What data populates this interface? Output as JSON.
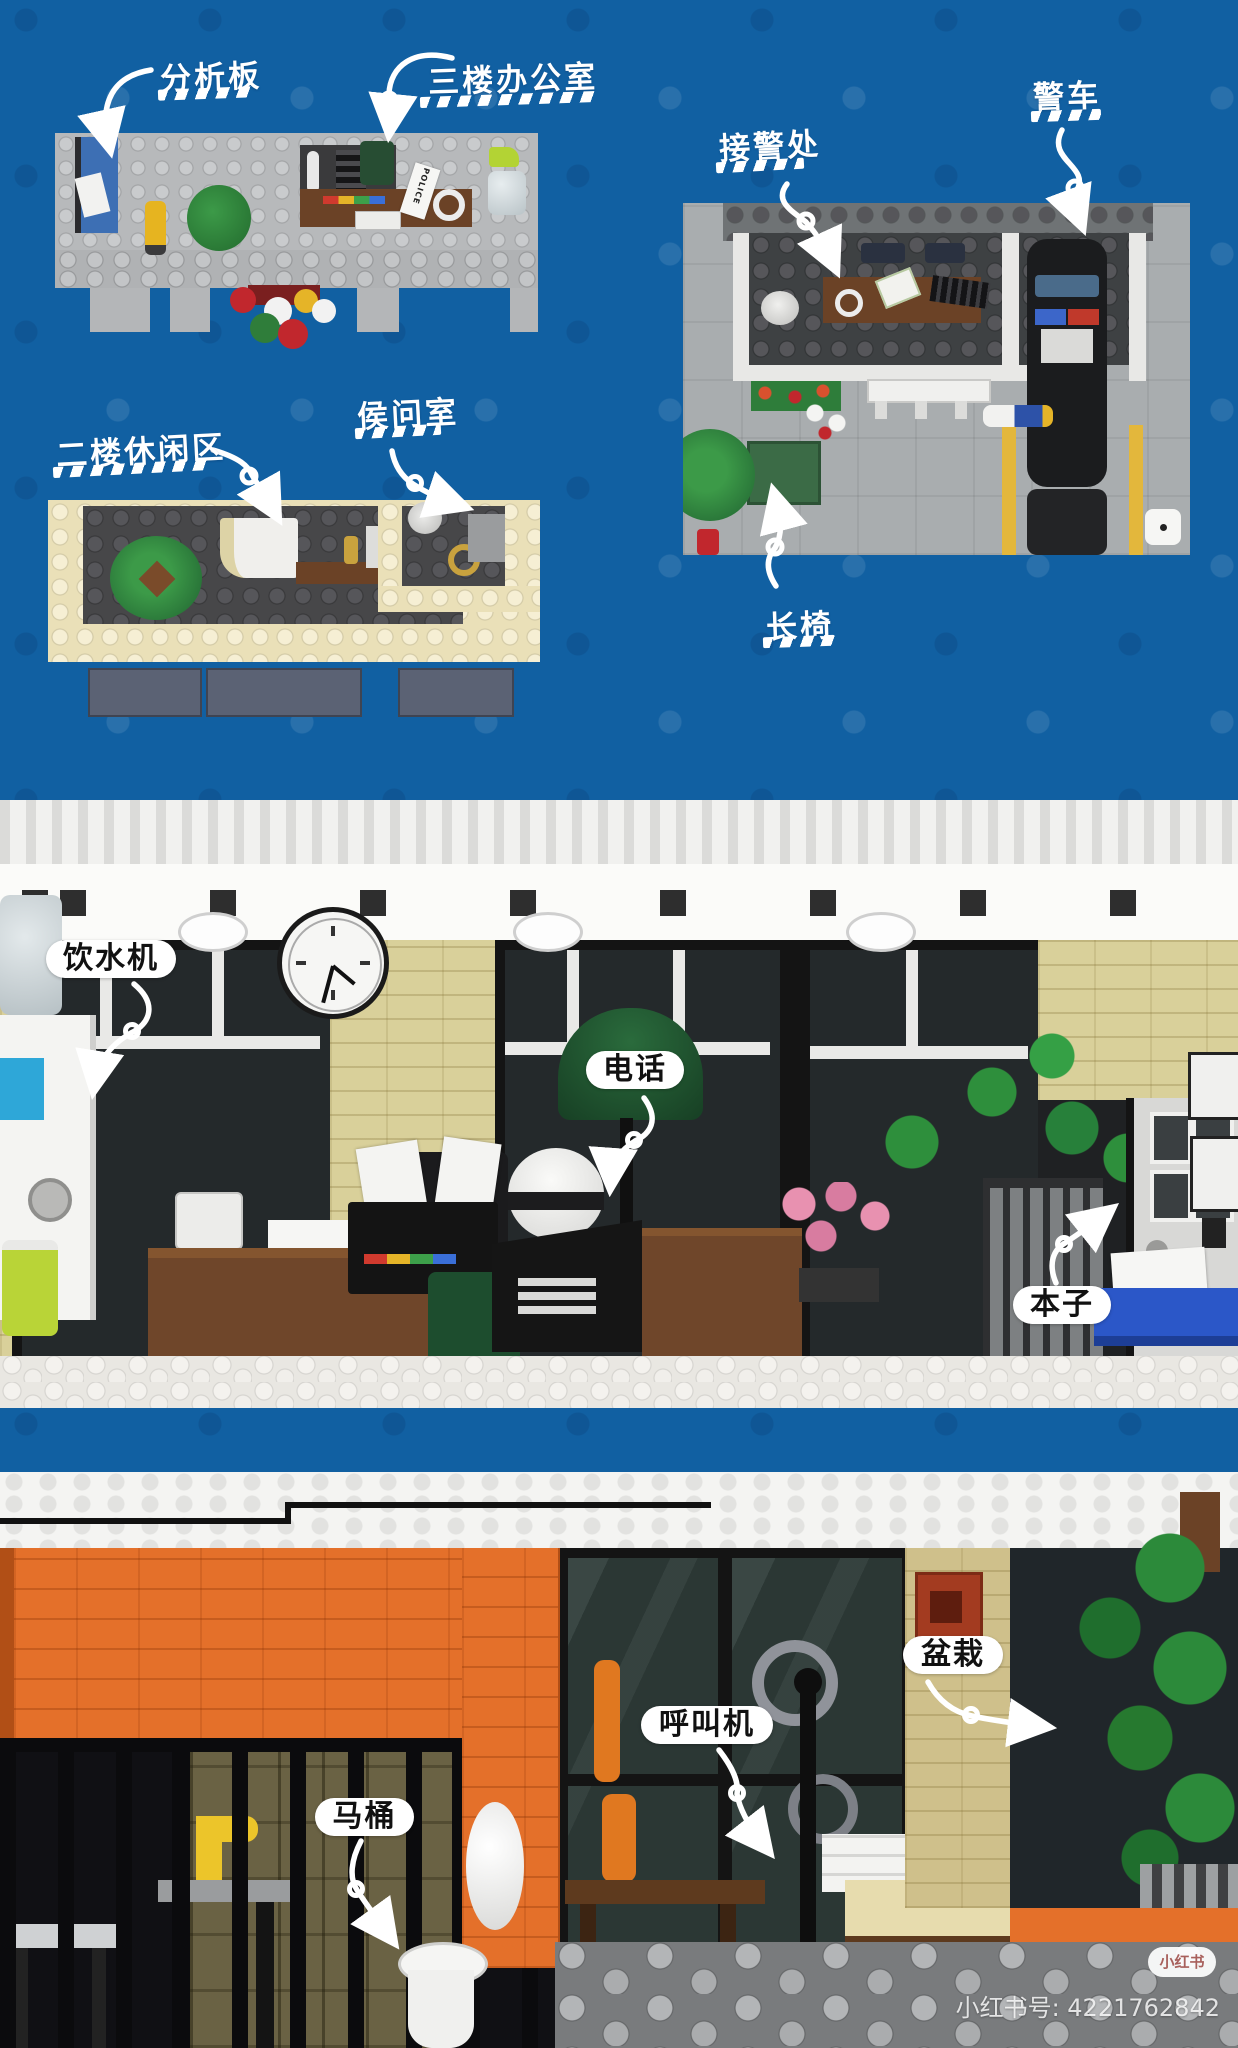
{
  "plan_labels": {
    "analysis_board": "分析板",
    "third_floor_office": "三楼办公室",
    "police_car": "警车",
    "reception": "接警处",
    "second_floor_lounge": "二楼休闲区",
    "interrogation_room": "侯问室",
    "bench": "长椅"
  },
  "detail_labels": {
    "water_dispenser": "饮水机",
    "telephone": "电话",
    "notebook": "本子",
    "potted_plant": "盆栽",
    "intercom": "呼叫机",
    "toilet": "马桶"
  },
  "photo_texts": {
    "police_note": "POLICE"
  },
  "watermark": {
    "logo": "小红书",
    "id_text": "小红书号: 4221762842"
  },
  "colors": {
    "background_blue": "#1160a2",
    "label_white": "#ffffff",
    "pill_text": "#111111",
    "building_orange": "#e4702a",
    "watermark_red": "#a8605c"
  }
}
